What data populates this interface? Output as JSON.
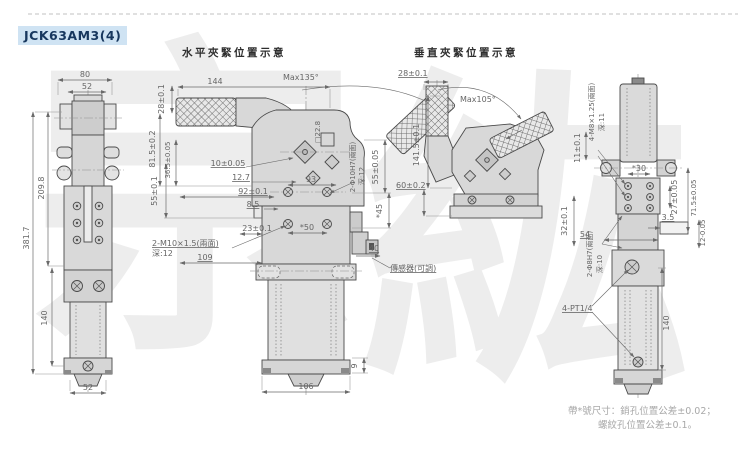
{
  "title": "JCK63AM3(4)",
  "watermark": {
    "char1": "宗",
    "char2": "紘"
  },
  "front_view": {
    "dim_width_outer": "80",
    "dim_width_inner": "52",
    "dim_height_total": "381.7",
    "dim_height_upper": "209.8",
    "dim_height_cylinder": "140",
    "dim_width_bottom": "52"
  },
  "horizontal_view": {
    "header": "水平夾緊位置示意",
    "dim_arm_height": "28±0.1",
    "dim_arm_length": "144",
    "dim_max_angle": "Max135°",
    "dim_815": "81.5±0.2",
    "dim_365": "36.5±0.05",
    "dim_55_left": "55±0.1",
    "dim_10": "10±0.05",
    "dim_127": "12.7",
    "dim_93": "93",
    "dim_92": "92±0.1",
    "dim_85": "8.5",
    "dim_23": "23±0.1",
    "dim_50": "*50",
    "thread_label": "2-M10×1.5(兩面)",
    "thread_depth": "深:12",
    "dim_109": "109",
    "dim_square": "□22.8",
    "pin_label": "2-Φ10H7(兩面)",
    "pin_depth": "深:12",
    "dim_55_right": "55±0.05",
    "dim_45": "*45",
    "dim_40": "40",
    "sensor_label": "傳感器(可調)",
    "dim_106": "106",
    "dim_9": "9"
  },
  "vertical_view": {
    "header": "垂直夾緊位置示意",
    "dim_28": "28±0.1",
    "dim_max_angle": "Max105°",
    "dim_1415": "141.5±0.1",
    "dim_60": "60±0.2"
  },
  "side_view": {
    "thread_label": "4-M8×1.25(兩面)",
    "thread_depth": "深:11",
    "dim_11": "11±0.1",
    "dim_30": "*30",
    "dim_27": "27±0.05",
    "dim_715": "71.5±0.05",
    "dim_32": "32±0.1",
    "dim_54": "54",
    "dim_35": "3.5",
    "dim_12": "12-0.05",
    "pin_label": "2-Φ8H7(兩面)",
    "pin_depth": "深:10",
    "port_label": "4-PT1/4",
    "dim_140": "140"
  },
  "note": {
    "line1": "帶*號尺寸：銷孔位置公差±0.02；",
    "line2": "螺紋孔位置公差±0.1。"
  },
  "colors": {
    "title_bg": "#cfe3f3",
    "title_text": "#17375e",
    "line": "#4a4a4a",
    "dim_text": "#666666",
    "fill_light": "#d8d8d8",
    "watermark": "#ededed"
  }
}
